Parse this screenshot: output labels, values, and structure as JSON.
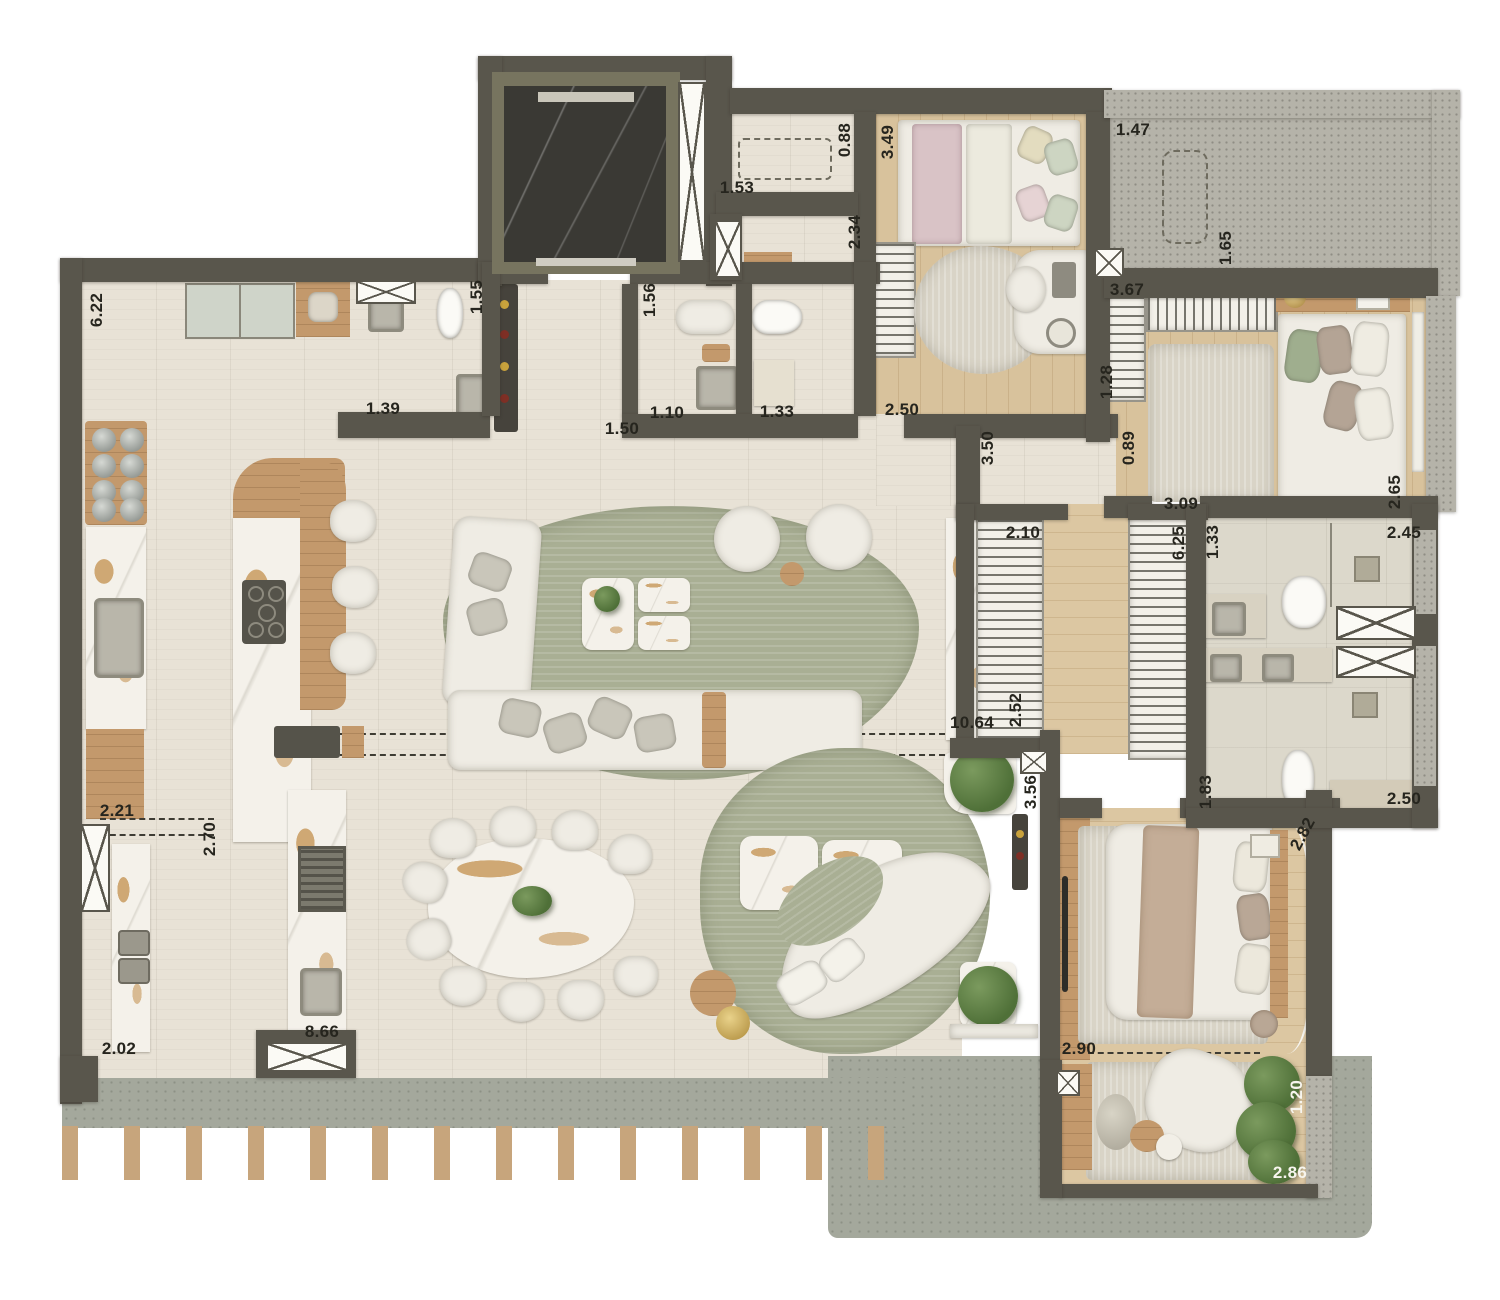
{
  "plan_type": "residential-apartment-floor-plan",
  "dimensions": [
    {
      "value": "6.22"
    },
    {
      "value": "1.39"
    },
    {
      "value": "1.55"
    },
    {
      "value": "1.53"
    },
    {
      "value": "0.88"
    },
    {
      "value": "3.49"
    },
    {
      "value": "2.34"
    },
    {
      "value": "1.47"
    },
    {
      "value": "1.65"
    },
    {
      "value": "3.67"
    },
    {
      "value": "1.28"
    },
    {
      "value": "1.56"
    },
    {
      "value": "1.10"
    },
    {
      "value": "1.33"
    },
    {
      "value": "2.50"
    },
    {
      "value": "1.50"
    },
    {
      "value": "3.50"
    },
    {
      "value": "0.89"
    },
    {
      "value": "3.09"
    },
    {
      "value": "2.65"
    },
    {
      "value": "2.45"
    },
    {
      "value": "2.10"
    },
    {
      "value": "6.25"
    },
    {
      "value": "1.33"
    },
    {
      "value": "2.52"
    },
    {
      "value": "10.64"
    },
    {
      "value": "3.56"
    },
    {
      "value": "1.83"
    },
    {
      "value": "2.50"
    },
    {
      "value": "2.82"
    },
    {
      "value": "2.90"
    },
    {
      "value": "1.20"
    },
    {
      "value": "2.86"
    },
    {
      "value": "2.21"
    },
    {
      "value": "2.70"
    },
    {
      "value": "2.02"
    },
    {
      "value": "8.66"
    }
  ],
  "colors": {
    "wall": "#59564c",
    "floor_tile": "#e8e2d6",
    "wood_floor": "#dcc7a2",
    "rug_green": "#a9af94",
    "terrace_gray": "#a4a89c",
    "granite_speckle": "#b5b3a9",
    "marble_gold_vein": "#b97c28",
    "elevator_dark_marble": "#3a3934",
    "furniture_white": "#efece4"
  }
}
